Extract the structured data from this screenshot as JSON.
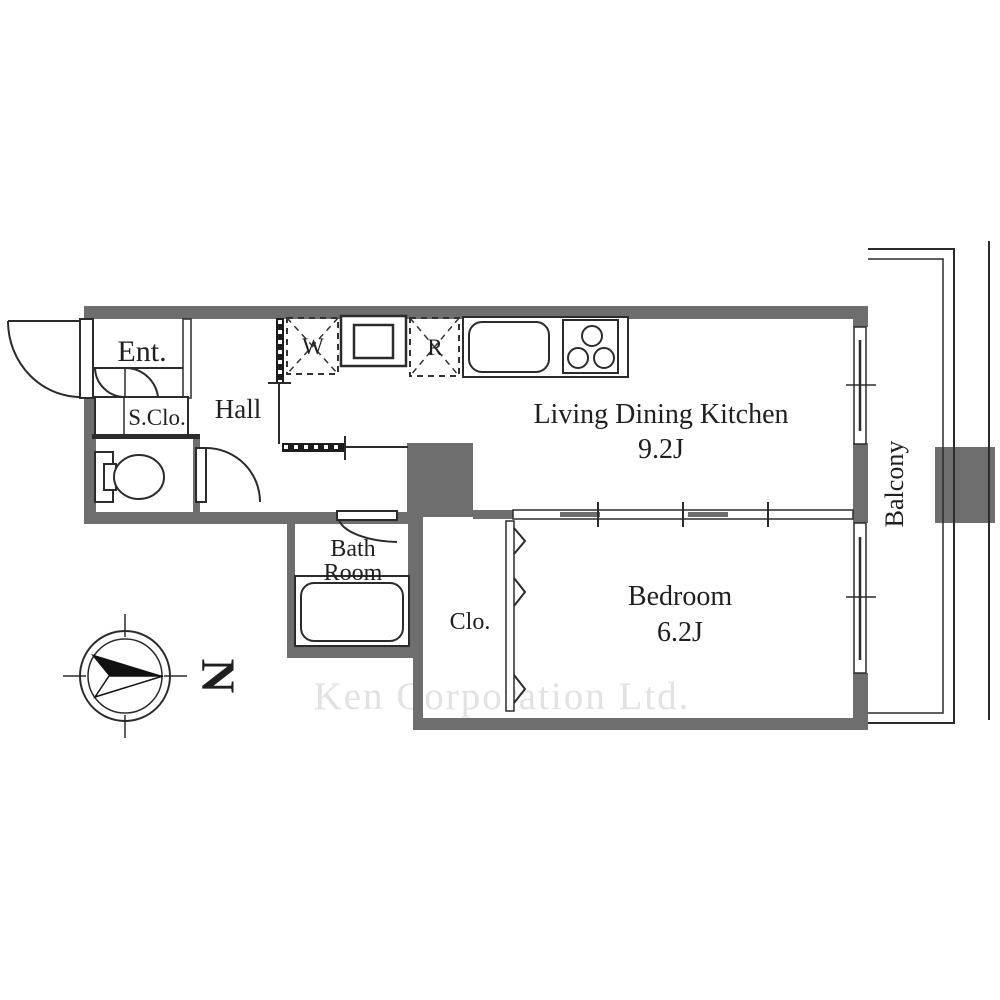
{
  "rooms": {
    "entrance": {
      "label": "Ent."
    },
    "shoe_closet": {
      "label": "S.Clo."
    },
    "hall": {
      "label": "Hall"
    },
    "living_dining_kitchen": {
      "label": "Living Dining Kitchen",
      "size": "9.2J"
    },
    "bedroom": {
      "label": "Bedroom",
      "size": "6.2J"
    },
    "closet": {
      "label": "Clo."
    },
    "bathroom": {
      "label_line1": "Bath",
      "label_line2": "Room"
    },
    "balcony": {
      "label": "Balcony"
    }
  },
  "appliances": {
    "washer_label": "W",
    "refrigerator_label": "R"
  },
  "compass": {
    "north_label": "N"
  },
  "watermark": "Ken Corporation Ltd.",
  "colors": {
    "wall": "#6e6e6e",
    "line": "#2b2b2b",
    "watermark": "#e2e2e2",
    "background": "#ffffff"
  }
}
